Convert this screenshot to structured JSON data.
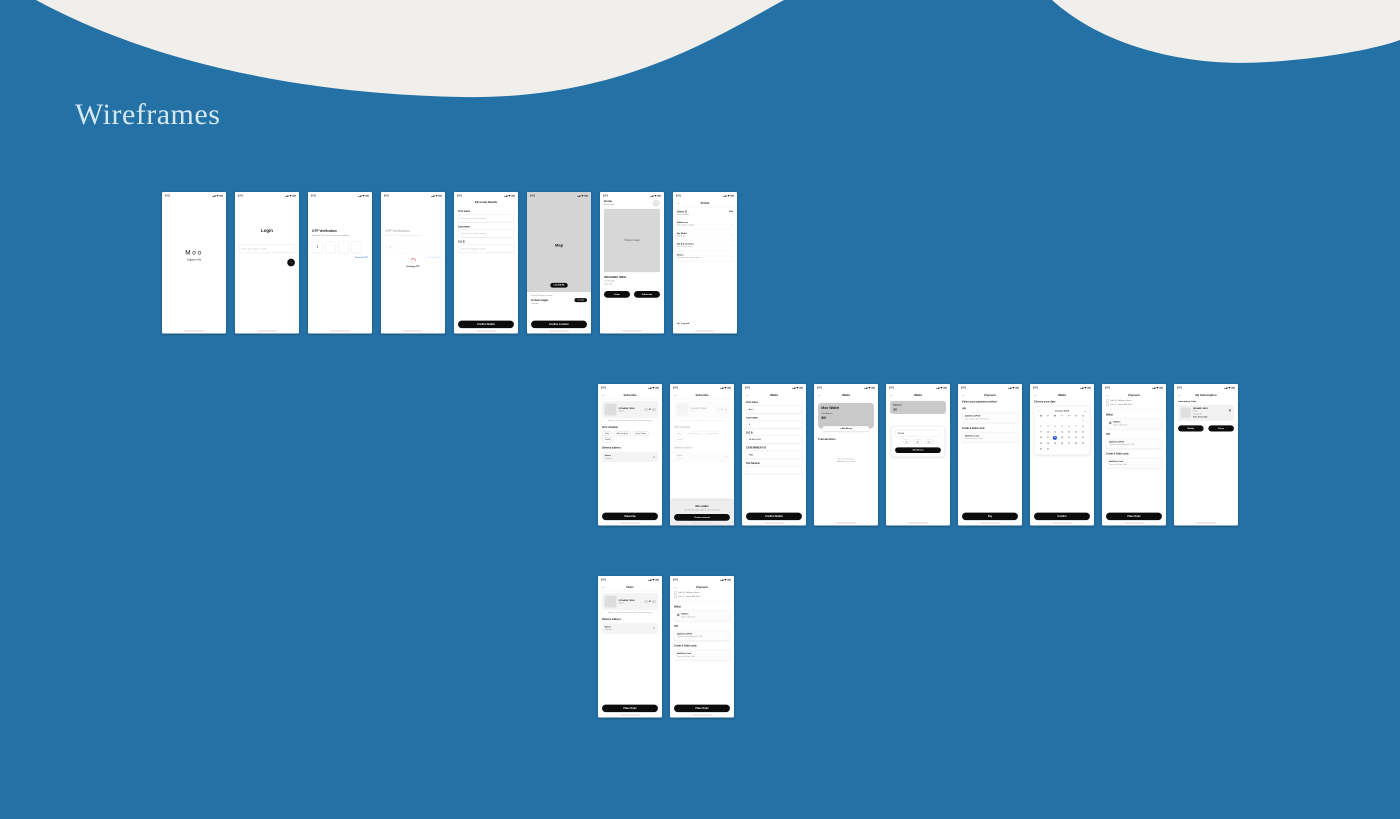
{
  "page": {
    "title": "Wireframes",
    "background": "#2471a6",
    "wave_color": "#f1efec",
    "title_color": "#d5e7f2"
  },
  "phone": {
    "time": "9:41",
    "status_icons": [
      "signal-icon",
      "wifi-icon",
      "battery-icon"
    ]
  },
  "icons": {
    "back": "←",
    "chev": "›",
    "pencil": "✎",
    "logout": "↪",
    "arrow": "→",
    "minus": "−",
    "plus": "+",
    "prev": "‹",
    "next": "›"
  },
  "rows": [
    {
      "x": 162,
      "y": 192,
      "pitch": 73,
      "screens": [
        "splash",
        "login",
        "otp",
        "otp_verify",
        "personal",
        "map",
        "home",
        "profile"
      ]
    },
    {
      "x": 598,
      "y": 384,
      "pitch": 72,
      "screens": [
        "subscribe",
        "subscribe_sheet",
        "wallet_form",
        "wallet_home",
        "wallet_add",
        "payment_methods",
        "wallet_calendar",
        "payment_order",
        "my_subscription"
      ]
    },
    {
      "x": 598,
      "y": 576,
      "pitch": 72,
      "screens": [
        "order",
        "payment_order"
      ]
    }
  ],
  "screens": {
    "splash": {
      "blocks": [
        {
          "t": "gap",
          "h": 150
        },
        {
          "t": "logo",
          "text": "Moo",
          "sub": "Organic milk"
        }
      ]
    },
    "login": {
      "blocks": [
        {
          "t": "gap",
          "h": 88
        },
        {
          "t": "ctitle",
          "text": "Login",
          "fs": 13
        },
        {
          "t": "gap",
          "h": 34
        },
        {
          "t": "input",
          "placeholder": "Enter your mobile number"
        },
        {
          "t": "circlebtn"
        }
      ]
    },
    "otp": {
      "blocks": [
        {
          "t": "gap",
          "h": 92
        },
        {
          "t": "heading",
          "text": "OTP Verification",
          "fs": 9.5
        },
        {
          "t": "sub",
          "text": "Enter the OTP sent to your email address",
          "mt": 4
        },
        {
          "t": "otp",
          "cells": [
            "1",
            "",
            "",
            ""
          ]
        },
        {
          "t": "link",
          "text": "Resend OTP"
        }
      ]
    },
    "otp_verify": {
      "faded": true,
      "overlay": {
        "type": "spinner",
        "label": "Verifying OTP"
      },
      "blocks": [
        {
          "t": "gap",
          "h": 92
        },
        {
          "t": "heading",
          "text": "OTP Verification",
          "fs": 9.5
        },
        {
          "t": "sub",
          "text": "Enter the OTP sent to your email address",
          "mt": 4
        },
        {
          "t": "otp",
          "cells": [
            "1",
            "",
            "",
            ""
          ]
        },
        {
          "t": "link",
          "text": "Resend OTP"
        }
      ]
    },
    "personal": {
      "blocks": [
        {
          "t": "gap",
          "h": 6
        },
        {
          "t": "ctitle",
          "text": "Personal Details",
          "fs": 8.5
        },
        {
          "t": "gap",
          "h": 10
        },
        {
          "t": "field",
          "label": "First name",
          "placeholder": "Enter your mobile number"
        },
        {
          "t": "field",
          "label": "Last name",
          "placeholder": "Enter your mobile number"
        },
        {
          "t": "field",
          "label": "D.O.B",
          "placeholder": "Enter your mobile number"
        },
        {
          "t": "btn",
          "label": "Confirm Details"
        }
      ]
    },
    "map": {
      "sgray": true,
      "blocks": [
        {
          "t": "map",
          "label": "Map",
          "pill": "LOCATE ME"
        },
        {
          "t": "sub",
          "text": "Select Delivery Location",
          "mt": 8
        },
        {
          "t": "locrow",
          "title": "Ashok nagar",
          "pill": "Change"
        },
        {
          "t": "sub",
          "text": "Chennai",
          "mt": 2
        },
        {
          "t": "btn",
          "label": "Confirm Location"
        }
      ]
    },
    "home": {
      "blocks": [
        {
          "t": "homehead",
          "title": "Home",
          "sub": "Ashok nagar"
        },
        {
          "t": "imgblock",
          "label": "Product Image",
          "h": 188
        },
        {
          "t": "heading",
          "text": "ORGANIC MILK",
          "fs": 9,
          "mt": 10
        },
        {
          "t": "sub",
          "text": "1 litre bottle",
          "mt": 3
        },
        {
          "t": "sub",
          "text": "Price: $4",
          "mt": 3
        },
        {
          "t": "btnrow",
          "labels": [
            "Order",
            "Subscribe"
          ]
        }
      ]
    },
    "profile": {
      "title": "Profile",
      "back": true,
      "hair": true,
      "blocks": [
        {
          "t": "phead",
          "name": "Arun S",
          "sub": "Phone number",
          "action": "Edit"
        },
        {
          "t": "gap",
          "h": 8
        },
        {
          "t": "litem",
          "title": "Addresses",
          "sub": "Add & edit your address"
        },
        {
          "t": "litem",
          "title": "My Wallet",
          "sub": "Add Money"
        },
        {
          "t": "litem",
          "title": "My Subscription",
          "sub": "Edit, Pause & cancel"
        },
        {
          "t": "litem",
          "title": "Status",
          "sub": "Check the status of your orders"
        },
        {
          "t": "logout",
          "label": "Log out"
        }
      ]
    },
    "subscribe": {
      "title": "Subscribe",
      "back": true,
      "hair": true,
      "blocks": [
        {
          "t": "pcard",
          "name": "ORGANIC MILK",
          "size": "500ml",
          "qty": "01"
        },
        {
          "t": "note",
          "text": "Take note: you can change or pause your subscription anytime"
        },
        {
          "t": "label",
          "text": "Pick schedule"
        },
        {
          "t": "chips",
          "items": [
            "Daily",
            "Alternate days",
            "Every 3 days",
            "Weekly"
          ]
        },
        {
          "t": "label",
          "text": "Delivery address"
        },
        {
          "t": "addr",
          "title": "Home",
          "sub": "Chennai"
        },
        {
          "t": "btn",
          "label": "Subscribe"
        }
      ]
    },
    "subscribe_sheet": {
      "title": "Subscribe",
      "back": true,
      "hair": true,
      "faded": true,
      "overlay": {
        "type": "sheet",
        "title": "Moo wallet",
        "sub": "You will need a Moo wallet to subscribe & order",
        "btn": "Create account"
      },
      "blocks": [
        {
          "t": "pcard",
          "name": "ORGANIC MILK",
          "size": "500ml",
          "qty": "01"
        },
        {
          "t": "note",
          "text": "Take note: you can change or pause your subscription anytime"
        },
        {
          "t": "label",
          "text": "Pick schedule"
        },
        {
          "t": "chips",
          "items": [
            "Daily",
            "Alternate days",
            "Every 3 days",
            "Weekly"
          ]
        },
        {
          "t": "label",
          "text": "Delivery address"
        },
        {
          "t": "addr",
          "title": "Home",
          "sub": "Chennai"
        },
        {
          "t": "btn",
          "label": "Subscribe"
        }
      ]
    },
    "wallet_form": {
      "title": "Wallet",
      "back": true,
      "blocks": [
        {
          "t": "field",
          "label": "First name",
          "value": "Arun"
        },
        {
          "t": "field",
          "label": "Last name",
          "value": "S"
        },
        {
          "t": "field",
          "label": "D.O.B",
          "value": "08-Mar-2001"
        },
        {
          "t": "field",
          "label": "GOVERNMENT ID",
          "value": "PAN"
        },
        {
          "t": "field",
          "label": "Pan Number",
          "value": ""
        },
        {
          "t": "btn",
          "label": "Confirm Details"
        }
      ]
    },
    "wallet_home": {
      "title": "Wallet",
      "back": true,
      "blocks": [
        {
          "t": "wcard",
          "title": "Moo Wallet",
          "cap": "Total Balance",
          "amount": "$0",
          "masked": "XXXX XXXX XXXX"
        },
        {
          "t": "wpill",
          "label": "+ Add Money"
        },
        {
          "t": "heading",
          "text": "Transactions",
          "fs": 8.5,
          "mt": 18
        },
        {
          "t": "empty",
          "lines": [
            "No recent transactions",
            "Add money to get started"
          ]
        }
      ]
    },
    "wallet_add": {
      "title": "Wallet",
      "back": true,
      "blocks": [
        {
          "t": "bcard",
          "cap": "Balance",
          "amount": "$0"
        },
        {
          "t": "acard",
          "value": "$  5000",
          "chips": [
            "50",
            "100",
            "500"
          ],
          "btn": "Add Money"
        }
      ]
    },
    "payment_methods": {
      "title": "Payment",
      "back": true,
      "blocks": [
        {
          "t": "heading",
          "text": "Select your payment method",
          "fs": 7.5,
          "mt": 6
        },
        {
          "t": "label",
          "text": "UPI"
        },
        {
          "t": "paycard",
          "title": "Add New UPI ID",
          "sub": "Pay using any registered UPI ID"
        },
        {
          "t": "label",
          "text": "Credit & Debit cards"
        },
        {
          "t": "paycard",
          "title": "Add New Card",
          "sub": "Save and Pay via Cards"
        },
        {
          "t": "btn",
          "label": "Pay"
        }
      ]
    },
    "wallet_calendar": {
      "title": "Wallet",
      "back": true,
      "blocks": [
        {
          "t": "heading",
          "text": "Choose your date",
          "fs": 7.5,
          "mt": 6
        },
        {
          "t": "cal",
          "month": "January 2023",
          "weekdays": [
            "M",
            "T",
            "W",
            "T",
            "F",
            "S",
            "S"
          ],
          "selected": "18",
          "weeks": [
            [
              "",
              "",
              "",
              "",
              "",
              "",
              "1"
            ],
            [
              "2",
              "3",
              "4",
              "5",
              "6",
              "7",
              "8"
            ],
            [
              "9",
              "10",
              "11",
              "12",
              "13",
              "14",
              "15"
            ],
            [
              "16",
              "17",
              "18",
              "19",
              "20",
              "21",
              "22"
            ],
            [
              "23",
              "24",
              "25",
              "26",
              "27",
              "28",
              "29"
            ],
            [
              "30",
              "31",
              "",
              "",
              "",
              "",
              ""
            ]
          ]
        },
        {
          "t": "btn",
          "label": "Confirm"
        }
      ]
    },
    "payment_order": {
      "title": "Payment",
      "back": true,
      "blocks": [
        {
          "t": "tinyrows",
          "rows": [
            "Total: $4 · Delivery at: Home",
            "Item: 01 · Organic Milk 500ml"
          ]
        },
        {
          "t": "label",
          "text": "Wallet"
        },
        {
          "t": "paycard",
          "radio": true,
          "title": "Wallets",
          "sub": "Balance: $4700.35"
        },
        {
          "t": "label",
          "text": "UPI"
        },
        {
          "t": "paycard",
          "title": "Add New UPI ID",
          "sub": "Checkout in your registered UPI ID"
        },
        {
          "t": "label",
          "text": "Credit & Debit cards"
        },
        {
          "t": "paycard",
          "title": "Add New Card",
          "sub": "Save and Pay via Cards"
        },
        {
          "t": "btn",
          "label": "Place Order"
        }
      ]
    },
    "my_subscription": {
      "title": "My Subscription",
      "back": true,
      "blocks": [
        {
          "t": "label",
          "text": "subscription: Daily",
          "fs": 6,
          "mt": 8
        },
        {
          "t": "subcard",
          "name": "ORGANIC MILK",
          "size": "500ml",
          "qty": "Quantity: 01",
          "until": "Until: 18-Jan-2023"
        },
        {
          "t": "btnrow",
          "labels": [
            "Modify",
            "Pause"
          ],
          "small": true
        }
      ]
    },
    "order": {
      "title": "Order",
      "back": true,
      "hair": true,
      "blocks": [
        {
          "t": "pcard",
          "name": "ORGANIC MILK",
          "size": "500ml",
          "qty": "01"
        },
        {
          "t": "note",
          "text": "Take note: you can change or pause your subscription anytime"
        },
        {
          "t": "label",
          "text": "Delivery address"
        },
        {
          "t": "addr",
          "title": "Home",
          "sub": "Chennai"
        },
        {
          "t": "btn",
          "label": "Place Order"
        }
      ]
    }
  }
}
